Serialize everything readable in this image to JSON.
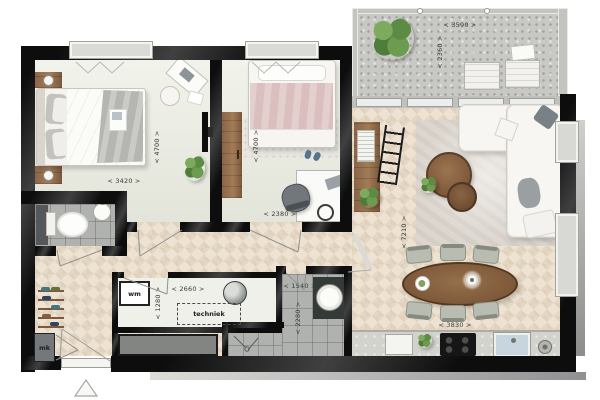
{
  "colors": {
    "wall": "#0d0d0d",
    "wall_sheen": "#404040",
    "bedroom_floor": "#eaece1",
    "wood_floor": "#eee3d3",
    "concrete": "#c8c9c5",
    "tile": "#b0b2af",
    "furniture_wood": "#8a6446",
    "plant_green": "#5f8f47",
    "bed_rose": "#d9bfbe",
    "dim_text": "#3b3b3b"
  },
  "dimensions": {
    "master_width": "< 3420 >",
    "master_depth": "< 4700 >",
    "bedroom2_depth": "< 4700 >",
    "bedroom2_width": "< 2380 >",
    "balcony_width": "< 3590 >",
    "balcony_depth": "< 2360 >",
    "living_depth": "< 7210 >",
    "living_width": "< 3830 >",
    "utility_width": "< 2660 >",
    "utility_depth": "< 1280 >",
    "bathroom_width": "< 1540 >",
    "bathroom_depth": "< 2280 >"
  },
  "labels": {
    "washing_machine": "wm",
    "technical_room": "techniek",
    "meter_cupboard": "mk"
  }
}
